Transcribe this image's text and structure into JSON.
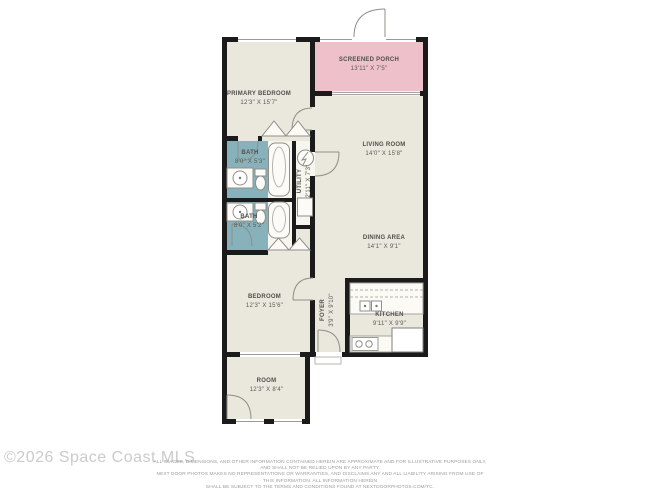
{
  "colors": {
    "wall": "#1b1b1b",
    "floor": "#eae8dd",
    "screened_porch_fill": "#eec0c9",
    "bath_fill": "#87b2bb",
    "fixture_stroke": "#8f8f88",
    "label_text": "#504f49",
    "watermark_text": "#cbcbcb",
    "disclaimer_text": "#9b9b9b"
  },
  "rooms": {
    "primary_bedroom": {
      "name": "PRIMARY BEDROOM",
      "dims": "12'3\" X 15'7\""
    },
    "screened_porch": {
      "name": "SCREENED PORCH",
      "dims": "13'11\" X 7'5\""
    },
    "living_room": {
      "name": "LIVING ROOM",
      "dims": "14'0\" X 15'8\""
    },
    "dining_area": {
      "name": "DINING AREA",
      "dims": "14'1\" X 9'1\""
    },
    "bath_primary": {
      "name": "BATH",
      "dims": "8'0\" X 5'3\""
    },
    "bath_second": {
      "name": "BATH",
      "dims": "8'0\" X 5'2\""
    },
    "utility": {
      "name": "UTILITY",
      "dims": "2'11\" X 7'3\""
    },
    "kitchen": {
      "name": "KITCHEN",
      "dims": "9'11\" X 9'9\""
    },
    "foyer": {
      "name": "FOYER",
      "dims": "3'9\" X 9'10\""
    },
    "bedroom": {
      "name": "BEDROOM",
      "dims": "12'3\" X 15'6\""
    },
    "room": {
      "name": "ROOM",
      "dims": "12'3\" X 8'4\""
    }
  },
  "footer": {
    "watermark": "©2026 Space Coast MLS",
    "disclaimer_lines": [
      "ALL IMAGES, DIMENSIONS, AND OTHER INFORMATION CONTAINED HEREIN ARE APPROXIMATE AND FOR ILLUSTRATIVE PURPOSES ONLY, AND SHALL NOT BE RELIED UPON BY ANY PARTY.",
      "NEXT DOOR PHOTOS MAKES NO REPRESENTATIONS OR WARRANTIES, AND DISCLAIMS ANY AND ALL LIABILITY ARISING FROM USE OF THIS INFORMATION. ALL INFORMATION HEREIN",
      "SHALL BE SUBJECT TO THE TERMS AND CONDITIONS FOUND AT NEXTDOORPHOTOS.COM/TC."
    ]
  }
}
